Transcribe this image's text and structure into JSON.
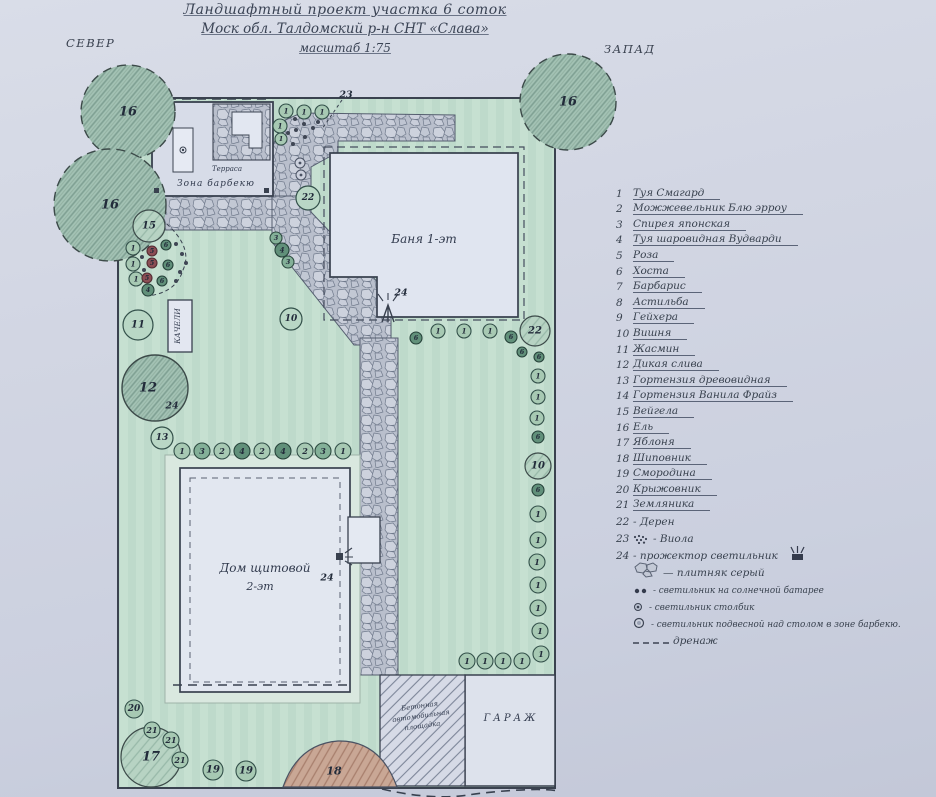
{
  "title": {
    "line1": "Ландшафтный проект  участка 6 соток",
    "line2": "Моск обл. Талдомский р-н  СНТ «Слава»",
    "line3": "масштаб 1:75"
  },
  "compass": {
    "north": "СЕВЕР",
    "west": "ЗАПАД"
  },
  "plan": {
    "buildings": {
      "bath": "Баня 1-эт",
      "house_line1": "Дом щитовой",
      "house_line2": "2-эт",
      "garage": "ГАРАЖ",
      "terrace": "Терраса",
      "bbq_zone": "Зона  барбекю",
      "swing": "КАЧЕЛИ",
      "concrete_line1": "Бетонная",
      "concrete_line2": "автомобильная",
      "concrete_line3": "площадка"
    },
    "area_labels": [
      {
        "t": "18",
        "x": 334,
        "y": 771,
        "fs": 11
      }
    ],
    "markers": [
      {
        "t": "23",
        "x": 346,
        "y": 95
      },
      {
        "t": "24",
        "x": 401,
        "y": 293
      },
      {
        "t": "24",
        "x": 327,
        "y": 578
      },
      {
        "t": "24",
        "x": 172,
        "y": 406
      }
    ],
    "trees": [
      {
        "t": "16",
        "x": 128,
        "y": 112,
        "r": 47,
        "k": "big",
        "dash": true
      },
      {
        "t": "16",
        "x": 110,
        "y": 205,
        "r": 56,
        "k": "big",
        "dash": true
      },
      {
        "t": "16",
        "x": 568,
        "y": 102,
        "r": 48,
        "k": "big",
        "dash": true
      },
      {
        "t": "12",
        "x": 155,
        "y": 388,
        "r": 33,
        "k": "big",
        "dash": false
      },
      {
        "t": "17",
        "x": 151,
        "y": 757,
        "r": 30,
        "k": "mid",
        "dash": false
      },
      {
        "t": "22",
        "x": 535,
        "y": 331,
        "r": 15,
        "k": "mid",
        "dash": false
      },
      {
        "t": "10",
        "x": 538,
        "y": 466,
        "r": 13,
        "k": "mid",
        "dash": false
      },
      {
        "t": "15",
        "x": 149,
        "y": 226,
        "r": 16,
        "k": "mid",
        "dash": false
      },
      {
        "t": "11",
        "x": 138,
        "y": 325,
        "r": 15,
        "k": "plain",
        "dash": false
      },
      {
        "t": "13",
        "x": 162,
        "y": 438,
        "r": 11,
        "k": "plain",
        "dash": false
      },
      {
        "t": "10",
        "x": 291,
        "y": 319,
        "r": 11,
        "k": "plain",
        "dash": false
      },
      {
        "t": "22",
        "x": 308,
        "y": 198,
        "r": 12,
        "k": "plain",
        "dash": false
      }
    ],
    "plants": [
      {
        "n": "1",
        "x": 286,
        "y": 111,
        "r": 7,
        "c": "g"
      },
      {
        "n": "1",
        "x": 304,
        "y": 112,
        "r": 7,
        "c": "g"
      },
      {
        "n": "1",
        "x": 322,
        "y": 112,
        "r": 7,
        "c": "g"
      },
      {
        "n": "1",
        "x": 280,
        "y": 126,
        "r": 7,
        "c": "g"
      },
      {
        "n": "1",
        "x": 281,
        "y": 139,
        "r": 6,
        "c": "g"
      },
      {
        "n": "6",
        "x": 416,
        "y": 338,
        "r": 6,
        "c": "d"
      },
      {
        "n": "1",
        "x": 438,
        "y": 331,
        "r": 7,
        "c": "g"
      },
      {
        "n": "1",
        "x": 464,
        "y": 331,
        "r": 7,
        "c": "g"
      },
      {
        "n": "1",
        "x": 490,
        "y": 331,
        "r": 7,
        "c": "g"
      },
      {
        "n": "6",
        "x": 511,
        "y": 337,
        "r": 6,
        "c": "d"
      },
      {
        "n": "6",
        "x": 522,
        "y": 352,
        "r": 5,
        "c": "d"
      },
      {
        "n": "6",
        "x": 539,
        "y": 357,
        "r": 5,
        "c": "d"
      },
      {
        "n": "1",
        "x": 538,
        "y": 376,
        "r": 7,
        "c": "g"
      },
      {
        "n": "1",
        "x": 538,
        "y": 397,
        "r": 7,
        "c": "g"
      },
      {
        "n": "1",
        "x": 537,
        "y": 418,
        "r": 7,
        "c": "g"
      },
      {
        "n": "6",
        "x": 538,
        "y": 437,
        "r": 6,
        "c": "d"
      },
      {
        "n": "6",
        "x": 538,
        "y": 490,
        "r": 6,
        "c": "d"
      },
      {
        "n": "1",
        "x": 538,
        "y": 514,
        "r": 8,
        "c": "g"
      },
      {
        "n": "1",
        "x": 538,
        "y": 540,
        "r": 8,
        "c": "g"
      },
      {
        "n": "1",
        "x": 537,
        "y": 562,
        "r": 8,
        "c": "g"
      },
      {
        "n": "1",
        "x": 538,
        "y": 585,
        "r": 8,
        "c": "g"
      },
      {
        "n": "1",
        "x": 538,
        "y": 608,
        "r": 8,
        "c": "g"
      },
      {
        "n": "1",
        "x": 540,
        "y": 631,
        "r": 8,
        "c": "g"
      },
      {
        "n": "1",
        "x": 541,
        "y": 654,
        "r": 8,
        "c": "g"
      },
      {
        "n": "1",
        "x": 467,
        "y": 661,
        "r": 8,
        "c": "g"
      },
      {
        "n": "1",
        "x": 485,
        "y": 661,
        "r": 8,
        "c": "g"
      },
      {
        "n": "1",
        "x": 503,
        "y": 661,
        "r": 8,
        "c": "g"
      },
      {
        "n": "1",
        "x": 522,
        "y": 661,
        "r": 8,
        "c": "g"
      },
      {
        "n": "1",
        "x": 182,
        "y": 451,
        "r": 8,
        "c": "g"
      },
      {
        "n": "3",
        "x": 202,
        "y": 451,
        "r": 8,
        "c": "m"
      },
      {
        "n": "2",
        "x": 222,
        "y": 451,
        "r": 8,
        "c": "g"
      },
      {
        "n": "4",
        "x": 242,
        "y": 451,
        "r": 8,
        "c": "d"
      },
      {
        "n": "2",
        "x": 262,
        "y": 451,
        "r": 8,
        "c": "g"
      },
      {
        "n": "4",
        "x": 283,
        "y": 451,
        "r": 8,
        "c": "d"
      },
      {
        "n": "2",
        "x": 305,
        "y": 451,
        "r": 8,
        "c": "g"
      },
      {
        "n": "3",
        "x": 323,
        "y": 451,
        "r": 8,
        "c": "m"
      },
      {
        "n": "1",
        "x": 343,
        "y": 451,
        "r": 8,
        "c": "g"
      },
      {
        "n": "1",
        "x": 133,
        "y": 248,
        "r": 7,
        "c": "g"
      },
      {
        "n": "5",
        "x": 152,
        "y": 251,
        "r": 5,
        "c": "r"
      },
      {
        "n": "6",
        "x": 166,
        "y": 245,
        "r": 5,
        "c": "d"
      },
      {
        "n": "1",
        "x": 133,
        "y": 264,
        "r": 7,
        "c": "g"
      },
      {
        "n": "5",
        "x": 152,
        "y": 263,
        "r": 5,
        "c": "r"
      },
      {
        "n": "6",
        "x": 168,
        "y": 265,
        "r": 5,
        "c": "d"
      },
      {
        "n": "1",
        "x": 136,
        "y": 279,
        "r": 7,
        "c": "g"
      },
      {
        "n": "5",
        "x": 147,
        "y": 278,
        "r": 5,
        "c": "r"
      },
      {
        "n": "6",
        "x": 162,
        "y": 281,
        "r": 5,
        "c": "d"
      },
      {
        "n": "4",
        "x": 148,
        "y": 290,
        "r": 6,
        "c": "d"
      },
      {
        "n": "3",
        "x": 276,
        "y": 238,
        "r": 6,
        "c": "m"
      },
      {
        "n": "4",
        "x": 282,
        "y": 250,
        "r": 7,
        "c": "d"
      },
      {
        "n": "3",
        "x": 288,
        "y": 262,
        "r": 6,
        "c": "m"
      },
      {
        "n": "20",
        "x": 134,
        "y": 709,
        "r": 9,
        "c": "g"
      },
      {
        "n": "21",
        "x": 152,
        "y": 730,
        "r": 8,
        "c": "g"
      },
      {
        "n": "21",
        "x": 171,
        "y": 740,
        "r": 8,
        "c": "g"
      },
      {
        "n": "21",
        "x": 180,
        "y": 760,
        "r": 8,
        "c": "g"
      },
      {
        "n": "19",
        "x": 213,
        "y": 770,
        "r": 10,
        "c": "g"
      },
      {
        "n": "19",
        "x": 246,
        "y": 771,
        "r": 10,
        "c": "g"
      }
    ],
    "viola_dots": [
      {
        "x": 295,
        "y": 119
      },
      {
        "x": 304,
        "y": 124
      },
      {
        "x": 313,
        "y": 128
      },
      {
        "x": 296,
        "y": 130
      },
      {
        "x": 288,
        "y": 133
      },
      {
        "x": 305,
        "y": 137
      },
      {
        "x": 318,
        "y": 122
      },
      {
        "x": 293,
        "y": 144
      },
      {
        "x": 176,
        "y": 244
      },
      {
        "x": 182,
        "y": 254
      },
      {
        "x": 186,
        "y": 263
      },
      {
        "x": 180,
        "y": 272
      },
      {
        "x": 176,
        "y": 281
      },
      {
        "x": 142,
        "y": 257
      },
      {
        "x": 144,
        "y": 270
      }
    ],
    "lamps": [
      {
        "x": 300,
        "y": 163
      },
      {
        "x": 301,
        "y": 175
      }
    ],
    "squares": [
      {
        "x": 154,
        "y": 188
      },
      {
        "x": 264,
        "y": 188
      }
    ]
  },
  "legend": {
    "items": [
      {
        "n": "1",
        "t": "Туя Смагард"
      },
      {
        "n": "2",
        "t": "Можжевельник  Блю эрроу"
      },
      {
        "n": "3",
        "t": "Спирея японская"
      },
      {
        "n": "4",
        "t": "Туя шаровидная  Вудварди"
      },
      {
        "n": "5",
        "t": "Роза"
      },
      {
        "n": "6",
        "t": "Хоста"
      },
      {
        "n": "7",
        "t": "Барбарис"
      },
      {
        "n": "8",
        "t": "Астильба"
      },
      {
        "n": "9",
        "t": "Гейхера"
      },
      {
        "n": "10",
        "t": "Вишня"
      },
      {
        "n": "11",
        "t": "Жасмин"
      },
      {
        "n": "12",
        "t": "Дикая слива"
      },
      {
        "n": "13",
        "t": "Гортензия  древовидная"
      },
      {
        "n": "14",
        "t": "Гортензия  Ванила Фрайз"
      },
      {
        "n": "15",
        "t": "Вейгела"
      },
      {
        "n": "16",
        "t": "Ель"
      },
      {
        "n": "17",
        "t": "Яблоня"
      },
      {
        "n": "18",
        "t": "Шиповник"
      },
      {
        "n": "19",
        "t": "Смородина"
      },
      {
        "n": "20",
        "t": "Крыжовник"
      },
      {
        "n": "21",
        "t": "Земляника"
      }
    ],
    "extras": [
      {
        "n": "22",
        "t": "- Дерен"
      },
      {
        "n": "23",
        "icon": "viola",
        "t": "- Виола"
      },
      {
        "n": "24",
        "t": "- прожектор светильник",
        "icon_after": "projector"
      },
      {
        "icon": "stones",
        "t": "— плитняк серый"
      },
      {
        "icon": "solar",
        "t": "- светильник на солнечной батарее",
        "sm": true
      },
      {
        "icon": "post",
        "t": "- светильник столбик",
        "sm": true
      },
      {
        "icon": "pendant",
        "t": "- светильник подвесной над столом  в зоне  барбекю.",
        "sm": true
      },
      {
        "icon": "dash",
        "t": "дренаж"
      }
    ]
  }
}
